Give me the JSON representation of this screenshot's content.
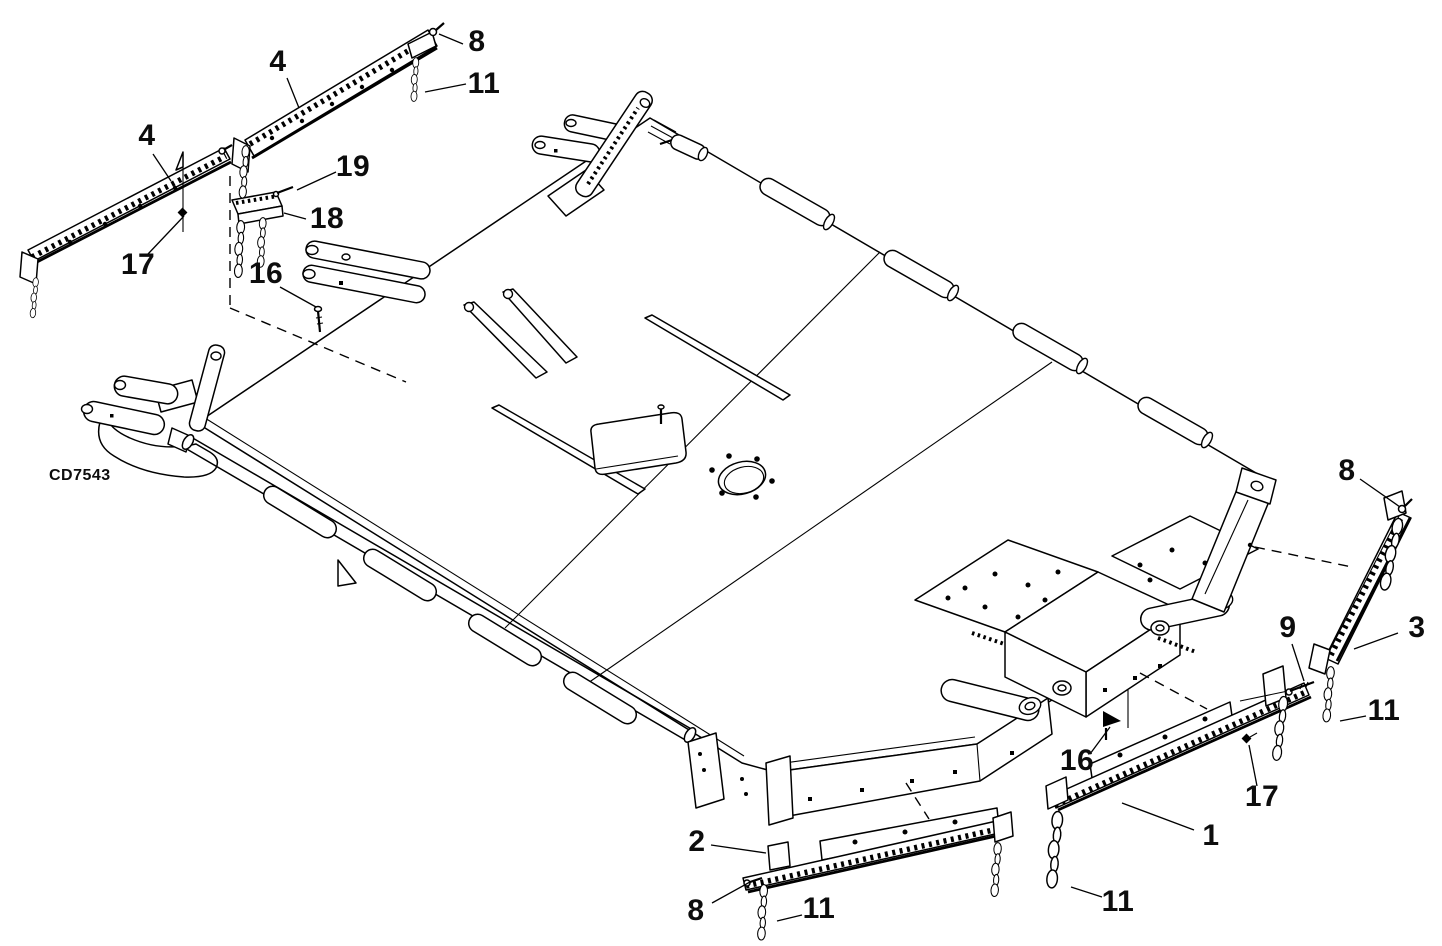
{
  "figure": {
    "code": "CD7543",
    "background": "#ffffff",
    "line_color": "#000000",
    "label_color": "#0d0d0d"
  },
  "callouts": [
    {
      "part": "4",
      "label": "4",
      "x": 278,
      "y": 62
    },
    {
      "part": "8",
      "label": "8",
      "x": 477,
      "y": 42
    },
    {
      "part": "11",
      "label": "11",
      "x": 484,
      "y": 84
    },
    {
      "part": "4",
      "label": "4",
      "x": 147,
      "y": 136
    },
    {
      "part": "19",
      "label": "19",
      "x": 353,
      "y": 167
    },
    {
      "part": "18",
      "label": "18",
      "x": 327,
      "y": 219
    },
    {
      "part": "17",
      "label": "17",
      "x": 138,
      "y": 265
    },
    {
      "part": "16",
      "label": "16",
      "x": 266,
      "y": 274
    },
    {
      "part": "8",
      "label": "8",
      "x": 1347,
      "y": 471
    },
    {
      "part": "3",
      "label": "3",
      "x": 1417,
      "y": 628
    },
    {
      "part": "9",
      "label": "9",
      "x": 1288,
      "y": 628
    },
    {
      "part": "11",
      "label": "11",
      "x": 1384,
      "y": 711
    },
    {
      "part": "16",
      "label": "16",
      "x": 1077,
      "y": 761
    },
    {
      "part": "17",
      "label": "17",
      "x": 1262,
      "y": 797
    },
    {
      "part": "1",
      "label": "1",
      "x": 1211,
      "y": 836
    },
    {
      "part": "11",
      "label": "11",
      "x": 1118,
      "y": 902
    },
    {
      "part": "2",
      "label": "2",
      "x": 697,
      "y": 842
    },
    {
      "part": "8",
      "label": "8",
      "x": 696,
      "y": 911
    },
    {
      "part": "11",
      "label": "11",
      "x": 819,
      "y": 909
    }
  ]
}
